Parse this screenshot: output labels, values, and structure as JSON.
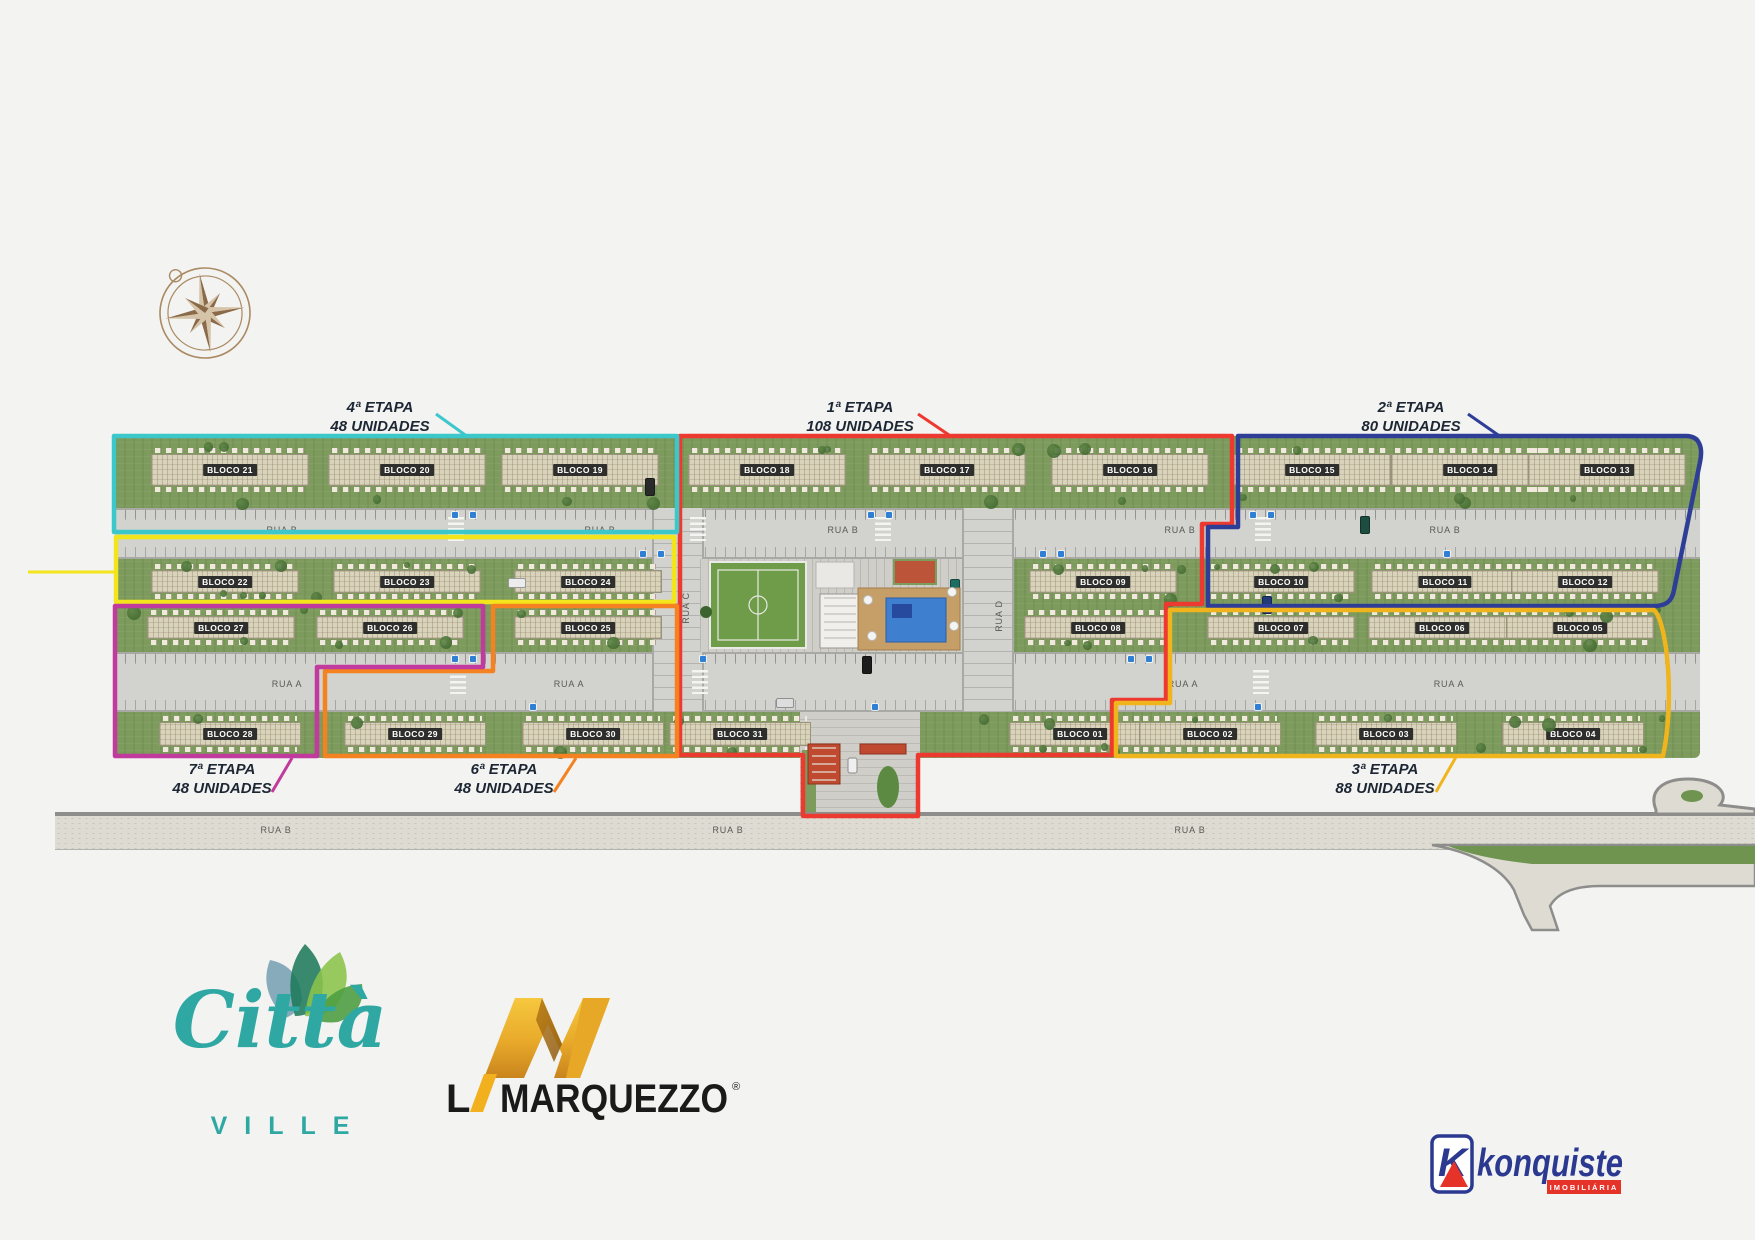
{
  "page": {
    "background": "#f3f3f2",
    "kind": "real-estate masterplan / site plan"
  },
  "etapas": [
    {
      "stage": "1ª ETAPA",
      "units": "108 UNIDADES",
      "color": "#ed3a30",
      "label_x": 860,
      "label_y": 398,
      "align": "center"
    },
    {
      "stage": "2ª ETAPA",
      "units": "80 UNIDADES",
      "color": "#2e3d96",
      "label_x": 1411,
      "label_y": 398,
      "align": "center"
    },
    {
      "stage": "3ª ETAPA",
      "units": "88 UNIDADES",
      "color": "#f0b41c",
      "label_x": 1385,
      "label_y": 760,
      "align": "center"
    },
    {
      "stage": "4ª ETAPA",
      "units": "48 UNIDADES",
      "color": "#3cc7cb",
      "label_x": 380,
      "label_y": 398,
      "align": "center"
    },
    {
      "stage": "5ª ETAPA",
      "units": "48 UNIDADES",
      "color": "#f2e51c",
      "label_x": 112,
      "label_y": 550,
      "align": "right"
    },
    {
      "stage": "6ª ETAPA",
      "units": "48 UNIDADES",
      "color": "#f58220",
      "label_x": 504,
      "label_y": 760,
      "align": "center"
    },
    {
      "stage": "7ª ETAPA",
      "units": "48 UNIDADES",
      "color": "#c13a9e",
      "label_x": 222,
      "label_y": 760,
      "align": "center"
    }
  ],
  "blocks": {
    "rows": [
      {
        "name": "row-top",
        "building_y": 448,
        "building_h": 44,
        "building_w": 158,
        "items": [
          {
            "label": "BLOCO 21",
            "cx": 230
          },
          {
            "label": "BLOCO 20",
            "cx": 407
          },
          {
            "label": "BLOCO 19",
            "cx": 580
          },
          {
            "label": "BLOCO 18",
            "cx": 767
          },
          {
            "label": "BLOCO 17",
            "cx": 947
          },
          {
            "label": "BLOCO 16",
            "cx": 1130
          },
          {
            "label": "BLOCO 15",
            "cx": 1312
          },
          {
            "label": "BLOCO 14",
            "cx": 1470
          },
          {
            "label": "BLOCO 13",
            "cx": 1607
          }
        ]
      },
      {
        "name": "row-2",
        "building_y": 564,
        "building_h": 35,
        "building_w": 148,
        "items": [
          {
            "label": "BLOCO 22",
            "cx": 225
          },
          {
            "label": "BLOCO 23",
            "cx": 407
          },
          {
            "label": "BLOCO 24",
            "cx": 588
          },
          {
            "label": "BLOCO 09",
            "cx": 1103
          },
          {
            "label": "BLOCO 10",
            "cx": 1281
          },
          {
            "label": "BLOCO 11",
            "cx": 1445
          },
          {
            "label": "BLOCO 12",
            "cx": 1585
          }
        ]
      },
      {
        "name": "row-3",
        "building_y": 610,
        "building_h": 35,
        "building_w": 148,
        "items": [
          {
            "label": "BLOCO 27",
            "cx": 221
          },
          {
            "label": "BLOCO 26",
            "cx": 390
          },
          {
            "label": "BLOCO 25",
            "cx": 588
          },
          {
            "label": "BLOCO 08",
            "cx": 1098
          },
          {
            "label": "BLOCO 07",
            "cx": 1281
          },
          {
            "label": "BLOCO 06",
            "cx": 1442
          },
          {
            "label": "BLOCO 05",
            "cx": 1580
          }
        ]
      },
      {
        "name": "row-bottom",
        "building_y": 716,
        "building_h": 36,
        "building_w": 142,
        "items": [
          {
            "label": "BLOCO 28",
            "cx": 230
          },
          {
            "label": "BLOCO 29",
            "cx": 415
          },
          {
            "label": "BLOCO 30",
            "cx": 593
          },
          {
            "label": "BLOCO 31",
            "cx": 740
          },
          {
            "label": "BLOCO 01",
            "cx": 1080
          },
          {
            "label": "BLOCO 02",
            "cx": 1210
          },
          {
            "label": "BLOCO 03",
            "cx": 1386
          },
          {
            "label": "BLOCO 04",
            "cx": 1573
          }
        ]
      }
    ]
  },
  "roads": {
    "rua_b_upper": {
      "label": "RUA B",
      "label_y": 530,
      "labels_x": [
        282,
        600,
        843,
        1180,
        1445
      ]
    },
    "rua_a": {
      "label": "RUA A",
      "label_y": 684,
      "labels_x": [
        287,
        569,
        1183,
        1449
      ]
    },
    "rua_c": {
      "label": "RUA C",
      "x": 686,
      "y": 608
    },
    "rua_d": {
      "label": "RUA D",
      "x": 999,
      "y": 616
    },
    "highway": {
      "label": "RUA B",
      "label_y": 830,
      "labels_x": [
        276,
        728,
        1190
      ]
    }
  },
  "logos": {
    "citta": {
      "word": "Città",
      "sub": "VILLE",
      "teal": "#2fa8a4"
    },
    "marquezzo": {
      "prefix": "L",
      "word": "MARQUEZZO",
      "reg": "®",
      "gold": "#f2b01e",
      "black": "#1a1a1a"
    },
    "konquiste": {
      "badge_letter": "K",
      "word": "konquiste",
      "sub": "IMOBILIÁRIA",
      "navy": "#2b3990",
      "red": "#e63329"
    }
  }
}
